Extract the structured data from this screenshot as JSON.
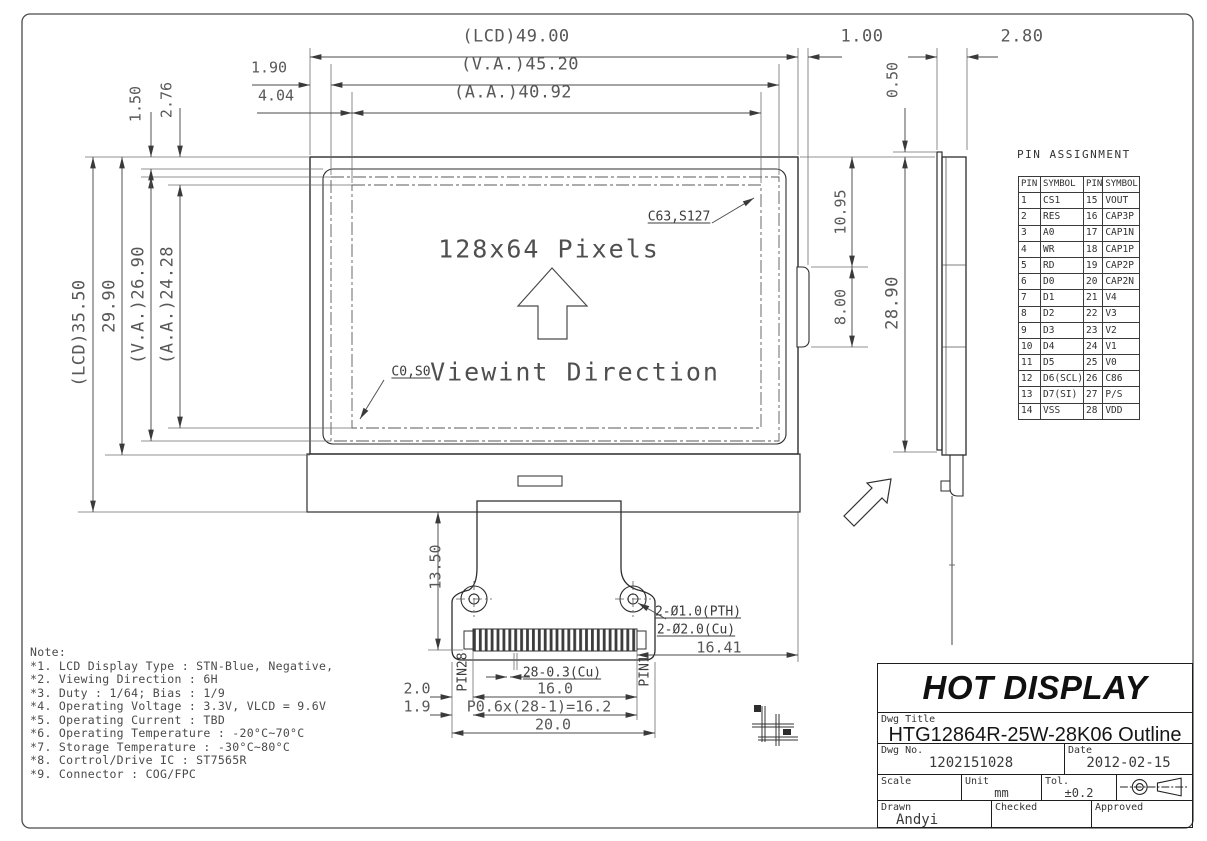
{
  "front_view": {
    "pixels_label": "128x64 Pixels",
    "viewing_label": "Viewint Direction",
    "corner_top_right": "C63,S127",
    "corner_bottom_left": "C0,S0"
  },
  "dims": {
    "top": {
      "lcd_width": "(LCD)49.00",
      "va_width": "(V.A.)45.20",
      "aa_width": "(A.A.)40.92",
      "edge_offset": "1.90",
      "aa_offset": "4.04",
      "bump_width": "1.00",
      "side_thickness": "2.80",
      "polarizer_offset": "0.50"
    },
    "left": {
      "lcd_height": "(LCD)35.50",
      "body_height": "29.90",
      "va_height": "(V.A.)26.90",
      "aa_height": "(A.A.)24.28",
      "top_offset": "1.50",
      "aa_top_offset": "2.76"
    },
    "right": {
      "upper": "10.95",
      "bump_height": "8.00",
      "total": "28.90"
    },
    "fpc": {
      "tail_length": "13.50",
      "hole_pth": "2-Ø1.0(PTH)",
      "hole_cu": "2-Ø2.0(Cu)",
      "pin1_to_edge": "16.41",
      "pad_width": "28-0.3(Cu)",
      "pad_span": "16.0",
      "pitch": "P0.6x(28-1)=16.2",
      "fpc_width": "20.0",
      "margin_top": "2.0",
      "margin_bottom": "1.9",
      "pin28": "PIN28",
      "pin1": "PIN1"
    }
  },
  "pin_assignment": {
    "title": "PIN ASSIGNMENT",
    "headers": [
      "PIN",
      "SYMBOL",
      "PIN",
      "SYMBOL"
    ],
    "rows": [
      [
        "1",
        "CS1",
        "15",
        "VOUT"
      ],
      [
        "2",
        "RES",
        "16",
        "CAP3P"
      ],
      [
        "3",
        "A0",
        "17",
        "CAP1N"
      ],
      [
        "4",
        "WR",
        "18",
        "CAP1P"
      ],
      [
        "5",
        "RD",
        "19",
        "CAP2P"
      ],
      [
        "6",
        "D0",
        "20",
        "CAP2N"
      ],
      [
        "7",
        "D1",
        "21",
        "V4"
      ],
      [
        "8",
        "D2",
        "22",
        "V3"
      ],
      [
        "9",
        "D3",
        "23",
        "V2"
      ],
      [
        "10",
        "D4",
        "24",
        "V1"
      ],
      [
        "11",
        "D5",
        "25",
        "V0"
      ],
      [
        "12",
        "D6(SCL)",
        "26",
        "C86"
      ],
      [
        "13",
        "D7(SI)",
        "27",
        "P/S"
      ],
      [
        "14",
        "VSS",
        "28",
        "VDD"
      ]
    ]
  },
  "notes": {
    "title": "Note:",
    "items": [
      "*1. LCD Display Type : STN-Blue, Negative,",
      "*2. Viewing Direction : 6H",
      "*3. Duty : 1/64; Bias : 1/9",
      "*4. Operating Voltage : 3.3V, VLCD = 9.6V",
      "*5. Operating Current : TBD",
      "*6. Operating Temperature : -20°C~70°C",
      "*7. Storage Temperature : -30°C~80°C",
      "*8. Cortrol/Drive IC : ST7565R",
      "*9. Connector : COG/FPC"
    ]
  },
  "title_block": {
    "company": "HOT DISPLAY",
    "labels": {
      "dwg_title": "Dwg Title",
      "dwg_no": "Dwg No.",
      "date": "Date",
      "scale": "Scale",
      "unit": "Unit",
      "tol": "Tol.",
      "drawn": "Drawn",
      "checked": "Checked",
      "approved": "Approved"
    },
    "values": {
      "title": "HTG12864R-25W-28K06 Outline",
      "no": "1202151028",
      "date": "2012-02-15",
      "unit": "mm",
      "tol": "±0.2",
      "drawn": "Andyi"
    }
  }
}
